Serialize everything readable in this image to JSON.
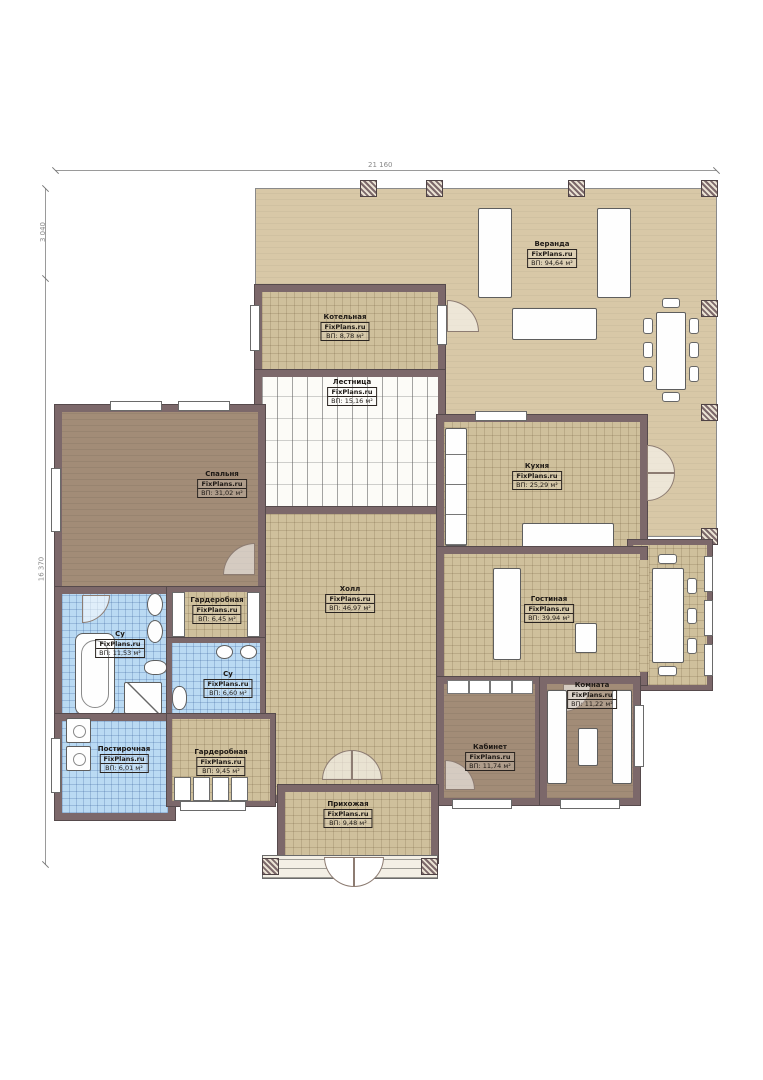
{
  "plan": {
    "watermark": "FixPlans.ru",
    "dimensions": {
      "width_total": "21 160",
      "height_upper": "3 040",
      "height_lower": "16 370"
    },
    "rooms": {
      "veranda": {
        "name": "Веранда",
        "area": "ВП: 94,64 м²"
      },
      "kotelnaya": {
        "name": "Котельная",
        "area": "ВП: 8,78 м²"
      },
      "lestnitsa": {
        "name": "Лестница",
        "area": "ВП: 15,16 м²"
      },
      "spalnya": {
        "name": "Спальня",
        "area": "ВП: 31,02 м²"
      },
      "kuhnya": {
        "name": "Кухня",
        "area": "ВП: 25,29 м²"
      },
      "holl": {
        "name": "Холл",
        "area": "ВП: 46,97 м²"
      },
      "gostinaya": {
        "name": "Гостиная",
        "area": "ВП: 39,94 м²"
      },
      "garderobnaya_1": {
        "name": "Гардеробная",
        "area": "ВП: 6,45 м²"
      },
      "su_1": {
        "name": "Су",
        "area": "ВП: 11,53 м²"
      },
      "su_2": {
        "name": "Су",
        "area": "ВП: 6,60 м²"
      },
      "postirochnaya": {
        "name": "Постирочная",
        "area": "ВП: 6,01 м²"
      },
      "garderobnaya_2": {
        "name": "Гардеробная",
        "area": "ВП: 9,45 м²"
      },
      "prihozhaya": {
        "name": "Прихожая",
        "area": "ВП: 9,48 м²"
      },
      "kabinet": {
        "name": "Кабинет",
        "area": "ВП: 11,74 м²"
      },
      "komnata": {
        "name": "Комната",
        "area": "ВП: 11,22 м²"
      }
    },
    "colors": {
      "wall": "#7c686a",
      "veranda_floor": "#d8c8a7",
      "tile_tan": "#cfc09c",
      "tile_blue": "#badaf3",
      "wood_brown": "#a28c77"
    }
  }
}
